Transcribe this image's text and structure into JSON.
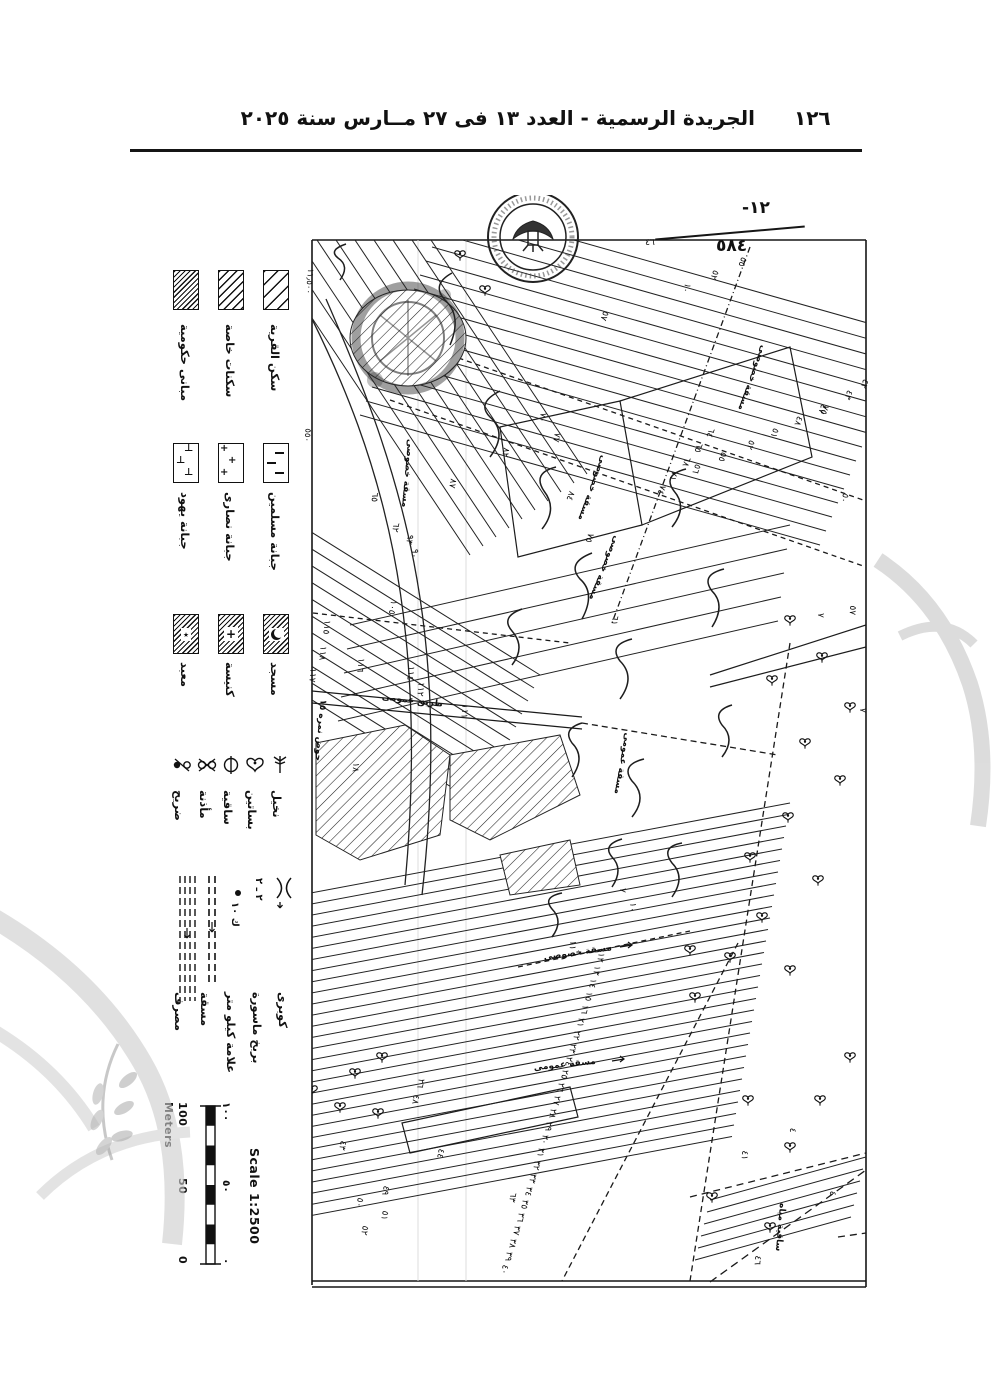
{
  "page": {
    "header_title": "الجريدة الرسمية - العدد ١٣ فى ٢٧ مــارس سنة ٢٠٢٥",
    "page_number": "١٢٦"
  },
  "annotation": {
    "numerator": "-١٢",
    "denominator": "٥٨٤"
  },
  "legend": {
    "areas": [
      {
        "label": "سكن القرية"
      },
      {
        "label": "سكنات خاصة"
      },
      {
        "label": "مبانى حكومية"
      }
    ],
    "cemeteries": [
      {
        "label": "جبانة مسلمين"
      },
      {
        "label": "جبانة نصارى"
      },
      {
        "label": "جبانة يهود"
      }
    ],
    "worship": [
      {
        "label": "مسجد"
      },
      {
        "label": "كنيسة"
      },
      {
        "label": "معبد"
      }
    ],
    "features": [
      {
        "label": "نخيل"
      },
      {
        "label": "بساتين"
      },
      {
        "label": "ساقية"
      },
      {
        "label": "مأذنة"
      },
      {
        "label": "ضريح"
      }
    ],
    "lines": [
      {
        "label": "كوبرى"
      },
      {
        "label": "بربخ ماسورة",
        "symbol_text": "٢ ـ ٢"
      },
      {
        "label": "علامة كيلو متر",
        "symbol_text": "ك ١٠"
      },
      {
        "label": "مسقة"
      },
      {
        "label": "مصرف"
      }
    ]
  },
  "scale": {
    "label": "Scale 1:2500",
    "unit": "Meters",
    "ticks_en": [
      "100",
      "50",
      "0"
    ],
    "ticks_ar": [
      "١٠٠",
      "٥٠",
      "٠"
    ]
  },
  "map": {
    "edge_values": [
      [
        "١١٫٥٠٠",
        157,
        86,
        95
      ],
      [
        "٥٥٠",
        155,
        240,
        95
      ]
    ],
    "labels": [
      [
        "مسقة خصوصى",
        600,
        182,
        110
      ],
      [
        "مسقة خصوصى",
        440,
        292,
        110
      ],
      [
        "مسقة خصوصى",
        452,
        372,
        112
      ],
      [
        "مسقة خصوصى",
        255,
        278,
        95
      ],
      [
        "مسقة عمومى",
        470,
        568,
        100
      ],
      [
        "مسقة خصوصى",
        428,
        760,
        -8
      ],
      [
        "مسقة عمومى",
        415,
        872,
        -6
      ],
      [
        "طريق عمومى",
        262,
        508,
        7
      ],
      [
        "حوض نمره ١٥",
        168,
        535,
        95
      ],
      [
        "ساقية مياه",
        628,
        1032,
        95
      ]
    ],
    "numbers": [
      [
        "٤٦",
        500,
        50,
        0
      ],
      [
        "٥٥",
        590,
        66,
        110
      ],
      [
        "٥٢",
        562,
        79,
        110
      ],
      [
        "١٠",
        534,
        92,
        110
      ],
      [
        "٥٧",
        452,
        120,
        110
      ],
      [
        "٤٢",
        712,
        188,
        110
      ],
      [
        "٤٣",
        696,
        199,
        110
      ],
      [
        "٤٧",
        670,
        213,
        110
      ],
      [
        "٤٨",
        646,
        225,
        110
      ],
      [
        "٥١",
        622,
        237,
        110
      ],
      [
        "٥٢",
        598,
        249,
        110
      ],
      [
        "٥٥",
        570,
        261,
        110
      ],
      [
        "٥٦",
        544,
        273,
        110
      ],
      [
        "٧٥",
        672,
        214,
        110
      ],
      [
        "٥٠",
        692,
        302,
        110
      ],
      [
        "٧",
        668,
        420,
        95
      ],
      [
        "٥٧",
        700,
        415,
        95
      ],
      [
        "٦٤",
        558,
        237,
        110
      ],
      [
        "٦٥",
        546,
        252,
        110
      ],
      [
        "٦٨",
        534,
        266,
        110
      ],
      [
        "٧١",
        521,
        280,
        110
      ],
      [
        "٧٤",
        509,
        294,
        110
      ],
      [
        "٧٠",
        390,
        222,
        100
      ],
      [
        "٧٧",
        404,
        242,
        100
      ],
      [
        "٨٢",
        353,
        257,
        100
      ],
      [
        "٨٧",
        300,
        288,
        100
      ],
      [
        "٦٢",
        243,
        332,
        100
      ],
      [
        "٩٣",
        257,
        344,
        100
      ],
      [
        "٩٠",
        262,
        358,
        100
      ],
      [
        "١٠٥",
        240,
        412,
        100
      ],
      [
        "٨٤",
        418,
        300,
        110
      ],
      [
        "٧٥",
        437,
        342,
        110
      ],
      [
        "٦١",
        462,
        425,
        100
      ],
      [
        "٦٥",
        222,
        302,
        95
      ],
      [
        "١١٥",
        174,
        432,
        95
      ],
      [
        "١١٨",
        170,
        458,
        95
      ],
      [
        "١١٧",
        160,
        480,
        95
      ],
      [
        "١١٦",
        208,
        470,
        95
      ],
      [
        "١١٤",
        258,
        478,
        95
      ],
      [
        "١١٢",
        268,
        494,
        95
      ],
      [
        "١١١",
        312,
        516,
        95
      ],
      [
        "١٨",
        203,
        572,
        95
      ],
      [
        "١٢",
        448,
        762,
        100
      ],
      [
        "١٣",
        444,
        775,
        100
      ],
      [
        "١٤",
        440,
        788,
        100
      ],
      [
        "١٥",
        436,
        801,
        100
      ],
      [
        "١٦",
        432,
        814,
        100
      ],
      [
        "٢١",
        428,
        827,
        100
      ],
      [
        "٢٢",
        424,
        840,
        100
      ],
      [
        "٢٣",
        420,
        853,
        100
      ],
      [
        "٢٤",
        416,
        866,
        100
      ],
      [
        "٢٥",
        412,
        879,
        100
      ],
      [
        "٢٦",
        408,
        892,
        100
      ],
      [
        "٢٧",
        404,
        905,
        100
      ],
      [
        "٢٨",
        400,
        918,
        100
      ],
      [
        "٢٩",
        396,
        931,
        100
      ],
      [
        "٣٠",
        392,
        944,
        100
      ],
      [
        "٣١",
        388,
        957,
        100
      ],
      [
        "٣٢",
        384,
        970,
        100
      ],
      [
        "٣٣",
        380,
        983,
        100
      ],
      [
        "٣٤",
        376,
        996,
        100
      ],
      [
        "٣٥",
        372,
        1009,
        100
      ],
      [
        "٣٦",
        368,
        1022,
        100
      ],
      [
        "٣٧",
        364,
        1035,
        100
      ],
      [
        "٣٨",
        360,
        1048,
        100
      ],
      [
        "٣٩",
        356,
        1061,
        100
      ],
      [
        "٤٠",
        352,
        1074,
        100
      ],
      [
        "٢٦",
        268,
        888,
        100
      ],
      [
        "٤٨",
        263,
        904,
        100
      ],
      [
        "٤٤",
        288,
        958,
        100
      ],
      [
        "٤٩",
        233,
        995,
        100
      ],
      [
        "٥٠",
        207,
        1007,
        100
      ],
      [
        "٥١",
        232,
        1020,
        100
      ],
      [
        "٤٣",
        190,
        950,
        100
      ],
      [
        "٦٣",
        360,
        1002,
        100
      ],
      [
        "٥٢",
        212,
        1035,
        100
      ],
      [
        "٤١",
        592,
        960,
        95
      ],
      [
        "٤",
        680,
        998,
        95
      ],
      [
        "٤٦",
        605,
        1065,
        95
      ],
      [
        "٤",
        640,
        935,
        95
      ],
      [
        "١١",
        420,
        750,
        95
      ],
      [
        "٧",
        470,
        695,
        95
      ],
      [
        "١٠",
        480,
        712,
        95
      ],
      [
        "٧",
        710,
        515,
        95
      ]
    ],
    "trees": [
      [
        640,
        425
      ],
      [
        672,
        462
      ],
      [
        700,
        512
      ],
      [
        622,
        485
      ],
      [
        655,
        548
      ],
      [
        690,
        585
      ],
      [
        638,
        622
      ],
      [
        600,
        662
      ],
      [
        668,
        685
      ],
      [
        612,
        722
      ],
      [
        580,
        762
      ],
      [
        640,
        775
      ],
      [
        545,
        802
      ],
      [
        598,
        905
      ],
      [
        640,
        952
      ],
      [
        562,
        1002
      ],
      [
        620,
        1032
      ],
      [
        205,
        878
      ],
      [
        232,
        862
      ],
      [
        190,
        912
      ],
      [
        228,
        918
      ],
      [
        162,
        895
      ],
      [
        670,
        905
      ],
      [
        700,
        862
      ],
      [
        540,
        755
      ],
      [
        310,
        60
      ],
      [
        335,
        95
      ]
    ]
  }
}
